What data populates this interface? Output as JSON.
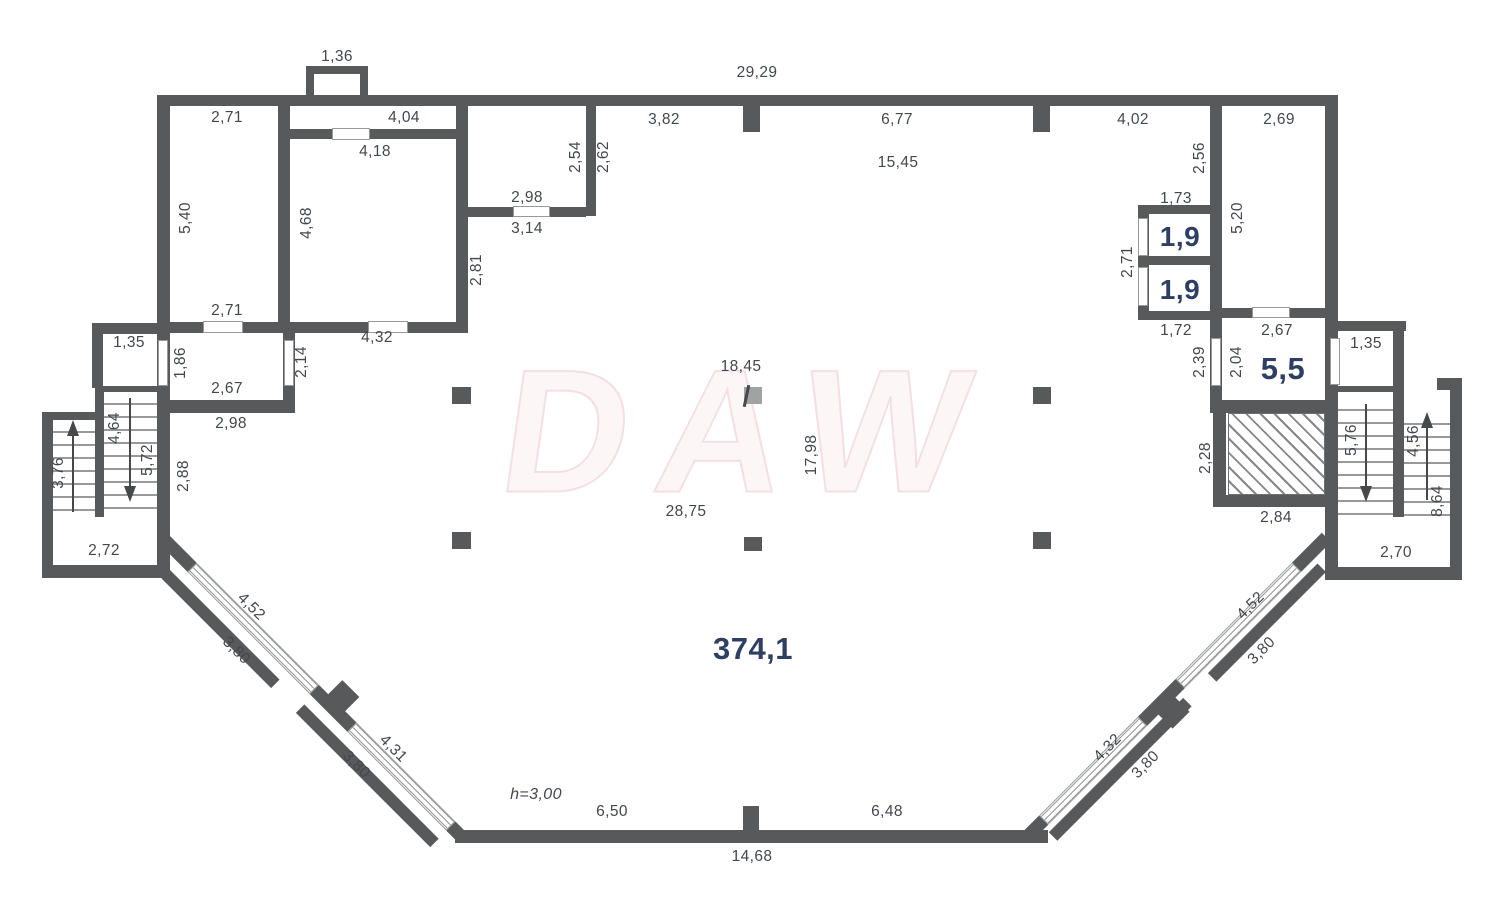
{
  "plan": {
    "watermark": "DAW",
    "total_area": "374,1",
    "height_note": "h=3,00",
    "room_areas": [
      "1,9",
      "1,9",
      "5,5"
    ]
  },
  "colors": {
    "wall": "#58595b",
    "window_line": "#97999b",
    "text": "#43474e",
    "area_accent": "#2e3f63"
  },
  "labels": [
    {
      "t": "1,36",
      "x": 337,
      "y": 57,
      "r": 0
    },
    {
      "t": "29,29",
      "x": 757,
      "y": 73,
      "r": 0
    },
    {
      "t": "2,71",
      "x": 227,
      "y": 118,
      "r": 0
    },
    {
      "t": "4,04",
      "x": 404,
      "y": 118,
      "r": 0
    },
    {
      "t": "3,82",
      "x": 664,
      "y": 120,
      "r": 0
    },
    {
      "t": "6,77",
      "x": 897,
      "y": 120,
      "r": 0
    },
    {
      "t": "4,02",
      "x": 1133,
      "y": 120,
      "r": 0
    },
    {
      "t": "2,69",
      "x": 1279,
      "y": 120,
      "r": 0
    },
    {
      "t": "4,18",
      "x": 375,
      "y": 152,
      "r": 0
    },
    {
      "t": "15,45",
      "x": 898,
      "y": 163,
      "r": 0
    },
    {
      "t": "2,98",
      "x": 527,
      "y": 198,
      "r": 0
    },
    {
      "t": "1,73",
      "x": 1176,
      "y": 199,
      "r": 0
    },
    {
      "t": "3,14",
      "x": 527,
      "y": 229,
      "r": 0
    },
    {
      "t": "2,71",
      "x": 227,
      "y": 311,
      "r": 0
    },
    {
      "t": "4,32",
      "x": 377,
      "y": 338,
      "r": 0
    },
    {
      "t": "1,72",
      "x": 1176,
      "y": 331,
      "r": 0
    },
    {
      "t": "2,67",
      "x": 1277,
      "y": 331,
      "r": 0
    },
    {
      "t": "1,35",
      "x": 129,
      "y": 343,
      "r": 0
    },
    {
      "t": "1,35",
      "x": 1366,
      "y": 344,
      "r": 0
    },
    {
      "t": "18,45",
      "x": 741,
      "y": 367,
      "r": 0
    },
    {
      "t": "2,67",
      "x": 227,
      "y": 389,
      "r": 0
    },
    {
      "t": "2,98",
      "x": 231,
      "y": 424,
      "r": 0
    },
    {
      "t": "28,75",
      "x": 686,
      "y": 512,
      "r": 0
    },
    {
      "t": "2,84",
      "x": 1276,
      "y": 518,
      "r": 0
    },
    {
      "t": "2,72",
      "x": 104,
      "y": 551,
      "r": 0
    },
    {
      "t": "2,70",
      "x": 1396,
      "y": 553,
      "r": 0
    },
    {
      "t": "6,50",
      "x": 612,
      "y": 812,
      "r": 0
    },
    {
      "t": "6,48",
      "x": 887,
      "y": 812,
      "r": 0
    },
    {
      "t": "14,68",
      "x": 752,
      "y": 857,
      "r": 0
    },
    {
      "t": "h=3,00",
      "x": 536,
      "y": 795,
      "r": 0,
      "k": "note"
    },
    {
      "t": "2,54",
      "x": 576,
      "y": 157,
      "r": -90
    },
    {
      "t": "2,62",
      "x": 604,
      "y": 157,
      "r": -90
    },
    {
      "t": "2,56",
      "x": 1200,
      "y": 158,
      "r": -90
    },
    {
      "t": "5,40",
      "x": 186,
      "y": 218,
      "r": -90
    },
    {
      "t": "5,20",
      "x": 1238,
      "y": 218,
      "r": -90
    },
    {
      "t": "4,68",
      "x": 307,
      "y": 223,
      "r": -90
    },
    {
      "t": "2,81",
      "x": 477,
      "y": 270,
      "r": -90
    },
    {
      "t": "2,71",
      "x": 1128,
      "y": 262,
      "r": -90
    },
    {
      "t": "1,86",
      "x": 181,
      "y": 363,
      "r": -90
    },
    {
      "t": "2,14",
      "x": 302,
      "y": 362,
      "r": -90
    },
    {
      "t": "2,39",
      "x": 1200,
      "y": 362,
      "r": -90
    },
    {
      "t": "2,04",
      "x": 1237,
      "y": 362,
      "r": -90
    },
    {
      "t": "4,64",
      "x": 115,
      "y": 428,
      "r": -90
    },
    {
      "t": "5,72",
      "x": 148,
      "y": 460,
      "r": -90
    },
    {
      "t": "3,76",
      "x": 59,
      "y": 473,
      "r": -90
    },
    {
      "t": "2,88",
      "x": 184,
      "y": 476,
      "r": -90
    },
    {
      "t": "17,98",
      "x": 812,
      "y": 455,
      "r": -90
    },
    {
      "t": "2,28",
      "x": 1206,
      "y": 458,
      "r": -90
    },
    {
      "t": "5,76",
      "x": 1352,
      "y": 440,
      "r": -90
    },
    {
      "t": "4,56",
      "x": 1414,
      "y": 441,
      "r": -90
    },
    {
      "t": "8,64",
      "x": 1438,
      "y": 501,
      "r": -90
    },
    {
      "t": "4,52",
      "x": 251,
      "y": 607,
      "r": 45
    },
    {
      "t": "3,80",
      "x": 236,
      "y": 651,
      "r": 45
    },
    {
      "t": "4,31",
      "x": 393,
      "y": 749,
      "r": 45
    },
    {
      "t": "3,80",
      "x": 356,
      "y": 765,
      "r": 45
    },
    {
      "t": "4,52",
      "x": 1251,
      "y": 606,
      "r": -45
    },
    {
      "t": "3,80",
      "x": 1262,
      "y": 651,
      "r": -45
    },
    {
      "t": "4,32",
      "x": 1108,
      "y": 748,
      "r": -45
    },
    {
      "t": "3,80",
      "x": 1146,
      "y": 765,
      "r": -45
    },
    {
      "t": "1,9",
      "x": 1180,
      "y": 237,
      "r": 0,
      "k": "area"
    },
    {
      "t": "1,9",
      "x": 1180,
      "y": 290,
      "r": 0,
      "k": "area"
    },
    {
      "t": "5,5",
      "x": 1283,
      "y": 369,
      "r": 0,
      "k": "area",
      "big": true
    },
    {
      "t": "374,1",
      "x": 753,
      "y": 649,
      "r": 0,
      "k": "area",
      "big": true
    }
  ]
}
